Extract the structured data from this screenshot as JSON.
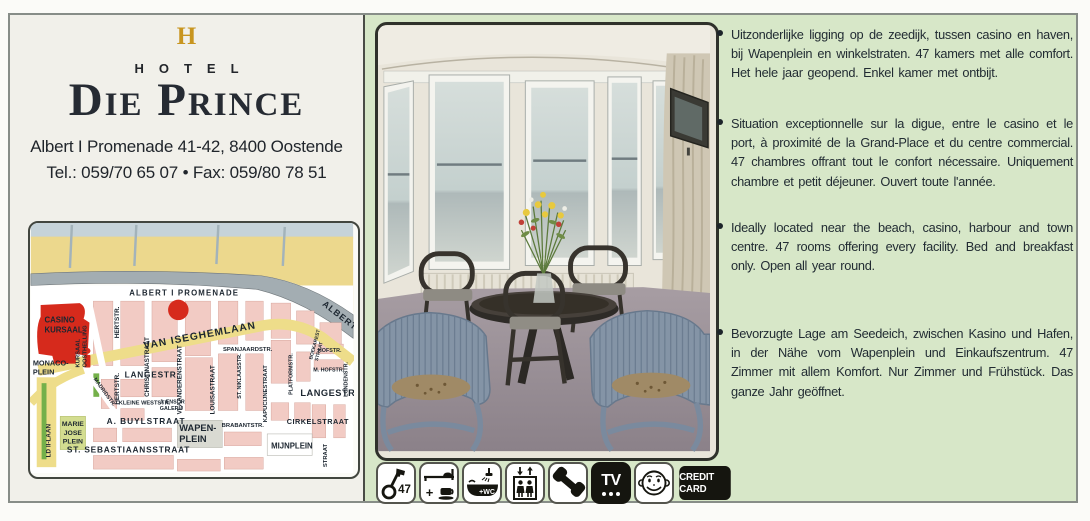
{
  "colors": {
    "panel_green": "#d7e7c8",
    "accent_gold": "#c8951f",
    "map_red": "#d62a1c",
    "map_yellow": "#eedd8a",
    "map_pink": "#f2cbc4"
  },
  "hotel": {
    "logo_initial": "H",
    "logo_word": "HOTEL",
    "name": "Die Prince",
    "address": "Albert I Promenade 41-42, 8400 Oostende",
    "contact": "Tel.: 059/70 65 07 • Fax: 059/80 78 51"
  },
  "descriptions": [
    "Uitzonderlijke ligging op de zeedijk, tussen casino en haven, bij Wapenplein en winkelstraten. 47 kamers met alle comfort. Het hele jaar geopend. Enkel kamer met ontbijt.",
    "Situation exceptionnelle sur la digue, entre le casino et le port, à proximité de la Grand-Place et du centre commercial. 47 chambres offrant tout le confort nécessaire. Uniquement chambre et petit déjeuner. Ouvert toute l'année.",
    "Ideally located near the beach, casino, harbour and town centre. 47 rooms offering every facility. Bed and breakfast only. Open all year round.",
    "Bevorzugte Lage am Seedeich, zwischen Kasino und Hafen, in der Nähe vom Wapenplein und Einkaufszentrum. 47 Zimmer mit allem Komfort. Nur Zimmer und Frühstück. Das ganze Jahr geöffnet."
  ],
  "amenities": {
    "rooms": "47",
    "plus": "+",
    "bath": "+WC",
    "tv": "TV",
    "credit_card": "CREDIT CARD",
    "icons": [
      "key-icon",
      "bed-breakfast-icon",
      "bath-wc-icon",
      "elevator-icon",
      "phone-icon",
      "tv-icon",
      "smiley-icon",
      "credit-card-badge"
    ]
  },
  "map": {
    "labels": {
      "albert_promenade": "ALBERT I PROMENADE",
      "albert_coast": "ALBERT I PR",
      "van_iseghemlaan": "VAN ISEGHEMLAAN",
      "casino": "CASINO\nKURSAAL",
      "kursaal_oosthelling": "KURSAAL\nOOSTHELLING",
      "hertstr_north": "HERTSTR.",
      "hertstr_south": "HERTSTR.",
      "christinastraat": "CHRISTINASTRAAT",
      "vlaanderenstraat": "VLAANDERENSTRAAT",
      "louisastraat": "LOUISASTRAAT",
      "st_niklaasstr": "ST. NIKLAASSTR.",
      "kapucijnestraat": "KAPUCIJNESTRAAT",
      "spanjaardstr": "SPANJAARDSTR.",
      "boekarest": "BOEKAREST\nSTRAAT",
      "platformstr": "PLATFORMSTR.",
      "hofstr": "HOFSTR.",
      "m_hofstr": "M. HOFSTR.",
      "londenstr": "LONDENSTR.",
      "langestr": "LANGESTR.",
      "langestraat": "LANGESTRAAT",
      "monacoplein": "MONACO-\nPLEIN",
      "madridstr": "MADRIDSTR.",
      "kleine_weststr": "KLEINE WESTSTR.",
      "ensor": "J. ENSOR\nGALERIJ",
      "marie_jose": "MARIE\nJOSE\nPLEIN",
      "a_buylstraat": "A. BUYLSTRAAT",
      "st_sebastiaansstraat": "ST. SEBASTIAANSSTRAAT",
      "wapenplein": "WAPEN-\nPLEIN",
      "brabantstr": "BRABANTSTR.",
      "mijnplein": "MIJNPLEIN",
      "cirkelstraat": "CIRKELSTRAAT",
      "leopold_laan": "LD II-LAAN",
      "straat_vert": "STRAAT"
    }
  }
}
